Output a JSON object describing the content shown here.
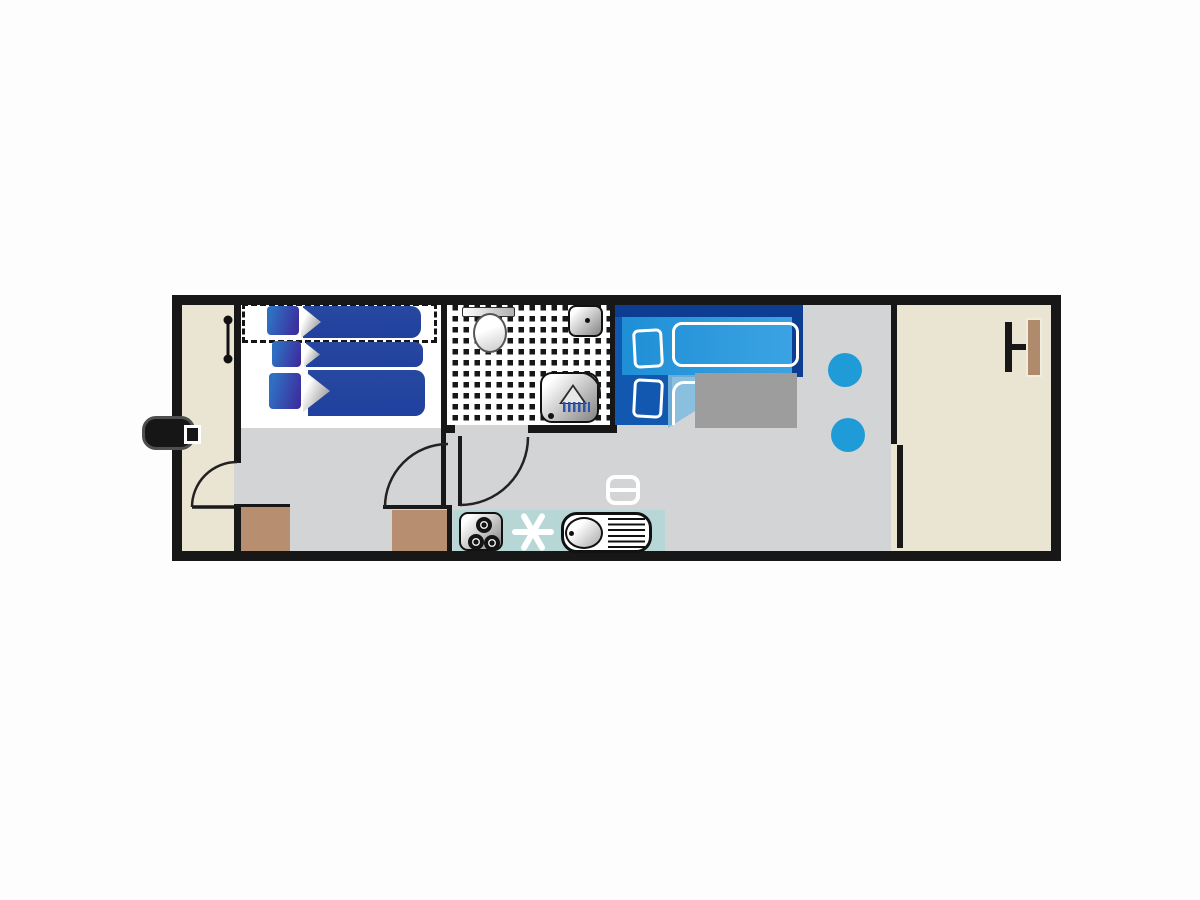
{
  "title": "mobile-home floor plan (no rendered text in image)",
  "colors": {
    "wall": "#171717",
    "floor_gray": "#d2d4d5",
    "floor_beige": "#eae5d3",
    "floor_white": "#ffffff",
    "kitchen_teal": "#b7d7d6",
    "cabinet_brown": "#b78f70",
    "bed_navy": "#21409f",
    "dbed_base": "#1257b0",
    "dbed_dark": "#0d3d93",
    "dbed_mattress": "#1f8fd6",
    "dbed_fade": "#7fbbdf",
    "stool_blue": "#1f9cd8",
    "table_gray": "#9d9d9d",
    "metal_dark": "#8a8a8a",
    "step_black": "#161616",
    "terrace_wood": "#b08a6d"
  },
  "rooms": [
    {
      "name": "entrance-hall",
      "floor": "beige"
    },
    {
      "name": "twin-bedroom",
      "floor": "white",
      "beds": 3,
      "note": "one fold-away bed shown dashed"
    },
    {
      "name": "bathroom",
      "floor": "black-white-checker",
      "fixtures": [
        "toilet",
        "washbasin",
        "shower"
      ]
    },
    {
      "name": "double-bedroom-living",
      "floor": "gray",
      "fixtures": [
        "double-bed",
        "side-table",
        "two-stools",
        "heater"
      ]
    },
    {
      "name": "kitchen-strip",
      "floor": "teal",
      "fixtures": [
        "stove",
        "fan-star",
        "sink-with-drainer"
      ]
    },
    {
      "name": "terrace",
      "floor": "beige",
      "fixtures": [
        "bench-table"
      ]
    }
  ],
  "icons": [
    "entrance-step-icon",
    "coat-rail-icon",
    "door-swing-arc-icon",
    "toilet-icon",
    "washbasin-icon",
    "shower-icon",
    "stove-burners-icon",
    "star-fan-icon",
    "kitchen-sink-icon",
    "heater-icon",
    "stool-icon",
    "bench-table-icon",
    "bed-pillow-icon",
    "bed-duvet-icon"
  ]
}
